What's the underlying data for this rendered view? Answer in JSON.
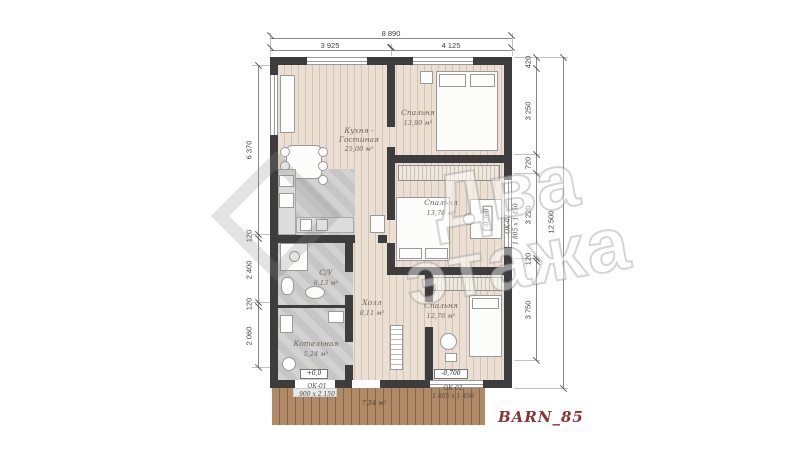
{
  "title": "BARN_85",
  "watermark": {
    "word1": "Два",
    "word2": "этажа"
  },
  "dimensions": {
    "top": {
      "overall": "8 890",
      "segments": [
        "3 925",
        "4 125"
      ]
    },
    "left": {
      "segments": [
        "6 370",
        "120",
        "2 400",
        "120",
        "2 060"
      ]
    },
    "right": {
      "overall": "12 500",
      "segments": [
        "420",
        "3 250",
        "720",
        "3 220",
        "120",
        "3 750"
      ]
    }
  },
  "rooms": {
    "kitchen": {
      "name": "Кухня - Гостиная",
      "area": "25,00 м²"
    },
    "bedroom1": {
      "name": "Спальня",
      "area": "13,90 м²"
    },
    "bedroom2": {
      "name": "Спальня",
      "area": "13,76 м²"
    },
    "bedroom3": {
      "name": "Спальня",
      "area": "12,76 м²"
    },
    "bathroom": {
      "name": "С/У",
      "area": "6,13 м²"
    },
    "hall": {
      "name": "Холл",
      "area": "8,11 м²"
    },
    "boiler": {
      "name": "Котельная",
      "area": "5,24 м²"
    },
    "terrace": {
      "area": "7,54 м²"
    }
  },
  "levels": {
    "entrance": "+0,0",
    "terrace": "-0,700",
    "window": "-0,360"
  },
  "windows": {
    "ok01": {
      "id": "ОК-01",
      "size": "900 х 2 150"
    },
    "ok02_bottom": {
      "id": "ОК-02",
      "size": "1 805 х 1 450"
    },
    "ok02_right": {
      "id": "ОК-02",
      "size": "1 805 х 1 450"
    }
  },
  "colors": {
    "wall": "#3d3d3d",
    "wood_floor": "#eadfd2",
    "tile_floor": "#c6c6c6",
    "deck": "#b08a66",
    "accent_title": "#8a3430"
  }
}
